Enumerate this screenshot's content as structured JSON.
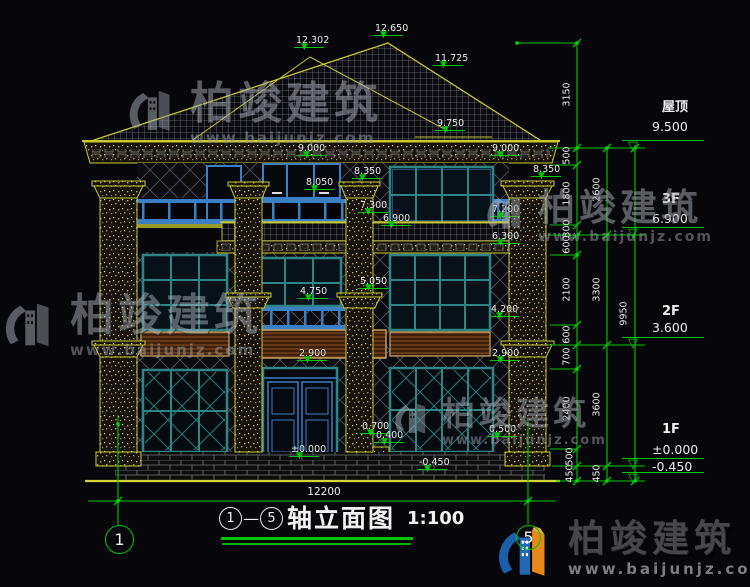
{
  "title": {
    "axis_start": "1",
    "axis_end": "5",
    "dash": "—",
    "text": "轴立面图",
    "scale": "1:100"
  },
  "axis_bubbles": [
    {
      "n": "1",
      "x": 105,
      "y": 525,
      "d": 27
    },
    {
      "n": "5",
      "x": 516,
      "y": 525,
      "d": 23
    }
  ],
  "bottom_dimension": "12200",
  "brand": {
    "name": "柏竣建筑",
    "url": "www.baijunjz.com"
  },
  "colors": {
    "cad_green": "#00c800",
    "cad_yellow": "#c8c832",
    "frame_teal": "#2f8585",
    "frame_blue": "#3b7fc4",
    "logo_blue": "#1b5fa8",
    "logo_orange": "#e8871a"
  },
  "elevation_markers": [
    {
      "v": "12.302",
      "x": 294,
      "y": 55
    },
    {
      "v": "12.650",
      "x": 373,
      "y": 43
    },
    {
      "v": "11.725",
      "x": 433,
      "y": 73
    },
    {
      "v": "9.750",
      "x": 435,
      "y": 138
    },
    {
      "v": "9.000",
      "x": 296,
      "y": 163
    },
    {
      "v": "8.350",
      "x": 352,
      "y": 186
    },
    {
      "v": "8.050",
      "x": 304,
      "y": 197
    },
    {
      "v": "7.300",
      "x": 358,
      "y": 220
    },
    {
      "v": "6.900",
      "x": 381,
      "y": 233
    },
    {
      "v": "5.050",
      "x": 358,
      "y": 296
    },
    {
      "v": "4.750",
      "x": 298,
      "y": 306
    },
    {
      "v": "2.900",
      "x": 297,
      "y": 368
    },
    {
      "v": "9.000",
      "x": 490,
      "y": 163
    },
    {
      "v": "8.350",
      "x": 531,
      "y": 184
    },
    {
      "v": "7.200",
      "x": 490,
      "y": 224
    },
    {
      "v": "6.300",
      "x": 490,
      "y": 251
    },
    {
      "v": "4.200",
      "x": 489,
      "y": 324
    },
    {
      "v": "2.900",
      "x": 490,
      "y": 368
    },
    {
      "v": "0.700",
      "x": 360,
      "y": 441
    },
    {
      "v": "0.400",
      "x": 374,
      "y": 450
    },
    {
      "v": "0.500",
      "x": 487,
      "y": 444
    },
    {
      "v": "±0.000",
      "x": 289,
      "y": 464
    },
    {
      "v": "-0.450",
      "x": 417,
      "y": 477
    }
  ],
  "vertical_dims": [
    {
      "v": "3150",
      "x": 567,
      "y": 95
    },
    {
      "v": "500",
      "x": 567,
      "y": 156
    },
    {
      "v": "1800",
      "x": 567,
      "y": 194
    },
    {
      "v": "300",
      "x": 567,
      "y": 229
    },
    {
      "v": "600",
      "x": 567,
      "y": 245
    },
    {
      "v": "2100",
      "x": 567,
      "y": 290
    },
    {
      "v": "600",
      "x": 567,
      "y": 335
    },
    {
      "v": "700",
      "x": 567,
      "y": 357
    },
    {
      "v": "2400",
      "x": 567,
      "y": 409
    },
    {
      "v": "500",
      "x": 570,
      "y": 457
    },
    {
      "v": "450",
      "x": 570,
      "y": 474
    },
    {
      "v": "2600",
      "x": 597,
      "y": 190
    },
    {
      "v": "3300",
      "x": 597,
      "y": 290
    },
    {
      "v": "3600",
      "x": 597,
      "y": 405
    },
    {
      "v": "450",
      "x": 597,
      "y": 474
    },
    {
      "v": "9950",
      "x": 624,
      "y": 314
    }
  ],
  "floor_markers": [
    {
      "name": "屋顶",
      "v": "9.500",
      "x": 620,
      "ny": 96,
      "vy": 119,
      "ly": 140,
      "ty": 141
    },
    {
      "name": "3F",
      "v": "6.900",
      "x": 620,
      "ny": 192,
      "vy": 211,
      "ly": 227,
      "ty": 228
    },
    {
      "name": "2F",
      "v": "3.600",
      "x": 620,
      "ny": 304,
      "vy": 320,
      "ly": 337,
      "ty": 338
    },
    {
      "name": "1F",
      "v": "±0.000",
      "x": 620,
      "ny": 422,
      "vy": 442,
      "ly": 458,
      "ty": 459
    },
    {
      "name": "",
      "v": "-0.450",
      "x": 620,
      "ny": 459,
      "vy": 459,
      "ly": 472,
      "ty": 473
    }
  ],
  "watermarks": [
    {
      "x": 128,
      "y": 82,
      "logo": 56,
      "fs": 44,
      "us": 15
    },
    {
      "x": 486,
      "y": 189,
      "logo": 46,
      "fs": 37,
      "us": 14
    },
    {
      "x": 4,
      "y": 294,
      "logo": 60,
      "fs": 44,
      "us": 15
    },
    {
      "x": 394,
      "y": 397,
      "logo": 42,
      "fs": 33,
      "us": 13
    }
  ]
}
